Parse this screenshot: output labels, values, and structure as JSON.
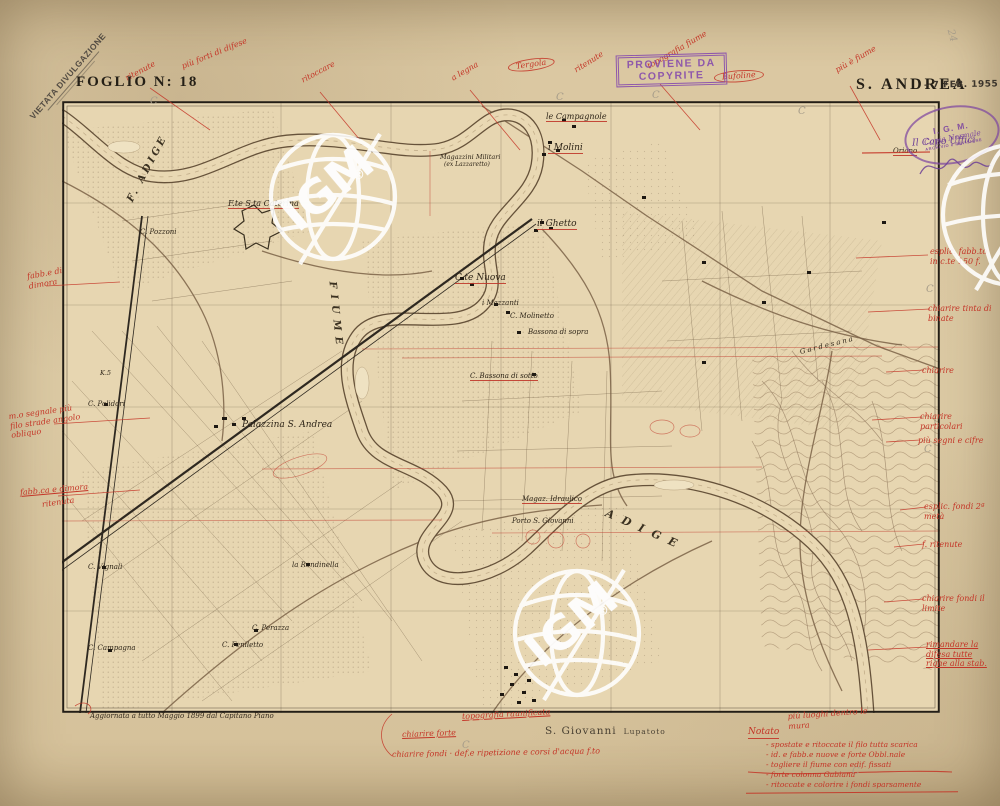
{
  "header": {
    "sheet_label": "FOGLIO N: 18",
    "sheet_name": "S. ANDREA",
    "date_stamp": "– 7 FEB. 1955"
  },
  "stamps": {
    "vietata": {
      "line1": "VIETATA DIVULGAZIONE"
    },
    "proviene": {
      "line1": "PROVIENE DA",
      "line2": "COPYRITE"
    },
    "igm_oval": {
      "line1": "I. G. M.",
      "line2": "Copia Normale",
      "line3": "ARCHIVIO e REVISIONE"
    },
    "capo": {
      "text": "Il Capo Uffici"
    }
  },
  "watermark": {
    "text": "IGM",
    "reg": "®"
  },
  "footer": {
    "revision": "Aggiornata a tutto Maggio 1899 dal Capitano Piano",
    "town": "S. Giovanni",
    "town_suffix": "Lupatoto"
  },
  "notes": {
    "heading": "Notato",
    "items": [
      "- spostate e ritoccate il filo tutta scarica",
      "- id. e fabb.e nuove e forte Obbl.nale",
      "- togliere il fiume con edif. fissati",
      "- forte colonna Gabiana",
      "- ritoccate e colorire i fondi sparsamente"
    ]
  },
  "map": {
    "labels": [
      {
        "t": "F. ADIGE",
        "x": 130,
        "y": 196,
        "rot": -62,
        "fs": 10,
        "ls": 3,
        "cls": "river"
      },
      {
        "t": "FIUME",
        "x": 332,
        "y": 276,
        "rot": 84,
        "fs": 10,
        "ls": 6,
        "cls": "river"
      },
      {
        "t": "ADIGE",
        "x": 606,
        "y": 506,
        "rot": 24,
        "fs": 11,
        "ls": 9,
        "cls": "river"
      },
      {
        "t": "le Campagnole",
        "x": 546,
        "y": 112,
        "fs": 8,
        "u": 1
      },
      {
        "t": "i Molini",
        "x": 548,
        "y": 143,
        "fs": 9,
        "u": 1
      },
      {
        "t": "il Ghetto",
        "x": 537,
        "y": 219,
        "fs": 9,
        "u": 1
      },
      {
        "t": "C.te Nuova",
        "x": 455,
        "y": 273,
        "fs": 9,
        "u": 1
      },
      {
        "t": "Palazzina S. Andrea",
        "x": 242,
        "y": 420,
        "fs": 9
      },
      {
        "t": "F.te S.ta Caterina",
        "x": 228,
        "y": 199,
        "fs": 8,
        "u": 1
      },
      {
        "t": "Magazzini Militari",
        "x": 440,
        "y": 153,
        "fs": 6.5
      },
      {
        "t": "(ex Lazzaretto)",
        "x": 444,
        "y": 161,
        "fs": 6
      },
      {
        "t": "C. Pozzoni",
        "x": 140,
        "y": 228,
        "fs": 7
      },
      {
        "t": "C. Polidori",
        "x": 88,
        "y": 400,
        "fs": 7
      },
      {
        "t": "K.5",
        "x": 100,
        "y": 369,
        "fs": 6.5
      },
      {
        "t": "C. Vignali",
        "x": 88,
        "y": 563,
        "fs": 7
      },
      {
        "t": "C. Campagna",
        "x": 88,
        "y": 644,
        "fs": 7
      },
      {
        "t": "C. Feniletto",
        "x": 222,
        "y": 641,
        "fs": 7
      },
      {
        "t": "C. Perazza",
        "x": 252,
        "y": 624,
        "fs": 7
      },
      {
        "t": "la Rondinella",
        "x": 292,
        "y": 561,
        "fs": 7
      },
      {
        "t": "i Mazzanti",
        "x": 482,
        "y": 299,
        "fs": 7
      },
      {
        "t": "C. Molinetto",
        "x": 510,
        "y": 312,
        "fs": 7
      },
      {
        "t": "Bassona di sopra",
        "x": 528,
        "y": 328,
        "fs": 7
      },
      {
        "t": "C. Bassona di sotto",
        "x": 470,
        "y": 372,
        "fs": 7,
        "u": 1
      },
      {
        "t": "Magaz. Idraulico",
        "x": 522,
        "y": 495,
        "fs": 7,
        "u": 1
      },
      {
        "t": "Porto S. Giovanni",
        "x": 512,
        "y": 517,
        "fs": 7
      },
      {
        "t": "Gardesana",
        "x": 800,
        "y": 348,
        "rot": -14,
        "fs": 7,
        "ls": 2
      },
      {
        "t": "Oriano",
        "x": 893,
        "y": 147,
        "fs": 7,
        "u": 1
      }
    ]
  },
  "annotations": {
    "top": [
      {
        "t": "ritenute",
        "x": 126,
        "y": 74,
        "rot": -28
      },
      {
        "t": "più forti di difese",
        "x": 182,
        "y": 62,
        "rot": -22
      },
      {
        "t": "ritoccare",
        "x": 302,
        "y": 76,
        "rot": -28
      },
      {
        "t": "a legna",
        "x": 452,
        "y": 74,
        "rot": -30
      },
      {
        "t": "Tergola",
        "x": 508,
        "y": 62,
        "rot": -8,
        "circ": 1
      },
      {
        "t": "ritenute",
        "x": 575,
        "y": 66,
        "rot": -32
      },
      {
        "t": "topografia fiume",
        "x": 648,
        "y": 62,
        "rot": -30
      },
      {
        "t": "Bufoline",
        "x": 714,
        "y": 72,
        "rot": -4,
        "circ": 1
      },
      {
        "t": "più è fiume",
        "x": 836,
        "y": 66,
        "rot": -30
      }
    ],
    "left": [
      {
        "t": "fabb.e di dimora",
        "x": 28,
        "y": 272,
        "rot": -10,
        "w": 62
      },
      {
        "t": "m.o segnale più filo strade angolo obliquo",
        "x": 10,
        "y": 412,
        "rot": -8,
        "w": 72
      },
      {
        "t": "fabb.ca e dimora",
        "x": 20,
        "y": 488,
        "rot": -5,
        "u": 1
      },
      {
        "t": "ritenuta",
        "x": 42,
        "y": 500,
        "rot": -8
      }
    ],
    "right": [
      {
        "t": "esplic. fabb.to in c.te 150 f.",
        "x": 930,
        "y": 247,
        "w": 66
      },
      {
        "t": "chiarire tinta di binate",
        "x": 928,
        "y": 304,
        "w": 64
      },
      {
        "t": "chiarire",
        "x": 922,
        "y": 366
      },
      {
        "t": "chiarire particolari",
        "x": 920,
        "y": 412,
        "w": 72
      },
      {
        "t": "più segni e cifre",
        "x": 918,
        "y": 436,
        "w": 72
      },
      {
        "t": "esplic. fondi 2ª metà",
        "x": 924,
        "y": 502,
        "w": 68
      },
      {
        "t": "f. ritenute",
        "x": 922,
        "y": 540
      },
      {
        "t": "chiarire fondi il limite",
        "x": 922,
        "y": 594,
        "w": 68
      },
      {
        "t": "rimandare la difesa tutte righe alla stab.",
        "x": 926,
        "y": 640,
        "w": 68,
        "u": 1
      }
    ],
    "bottom": [
      {
        "t": "topografia raunificata",
        "x": 462,
        "y": 712,
        "rot": -3,
        "u": 1
      },
      {
        "t": "più luoghi dentro le mura",
        "x": 788,
        "y": 712,
        "rot": -4,
        "w": 92
      },
      {
        "t": "chiarire forte",
        "x": 402,
        "y": 730,
        "rot": -2,
        "u": 1
      },
      {
        "t": "chiarire fondi · def.e ripetizione e corsi d'acqua f.to",
        "x": 392,
        "y": 750,
        "rot": -1
      }
    ]
  },
  "pencil_marks": [
    {
      "t": "C",
      "x": 150,
      "y": 96
    },
    {
      "t": "C",
      "x": 556,
      "y": 92
    },
    {
      "t": "C",
      "x": 652,
      "y": 90
    },
    {
      "t": "C",
      "x": 798,
      "y": 106
    },
    {
      "t": "C",
      "x": 462,
      "y": 740
    },
    {
      "t": "C",
      "x": 926,
      "y": 284
    },
    {
      "t": "C",
      "x": 924,
      "y": 444
    },
    {
      "t": "C",
      "x": 852,
      "y": 766
    },
    {
      "t": "24",
      "x": 950,
      "y": 24,
      "rot": 75
    }
  ]
}
